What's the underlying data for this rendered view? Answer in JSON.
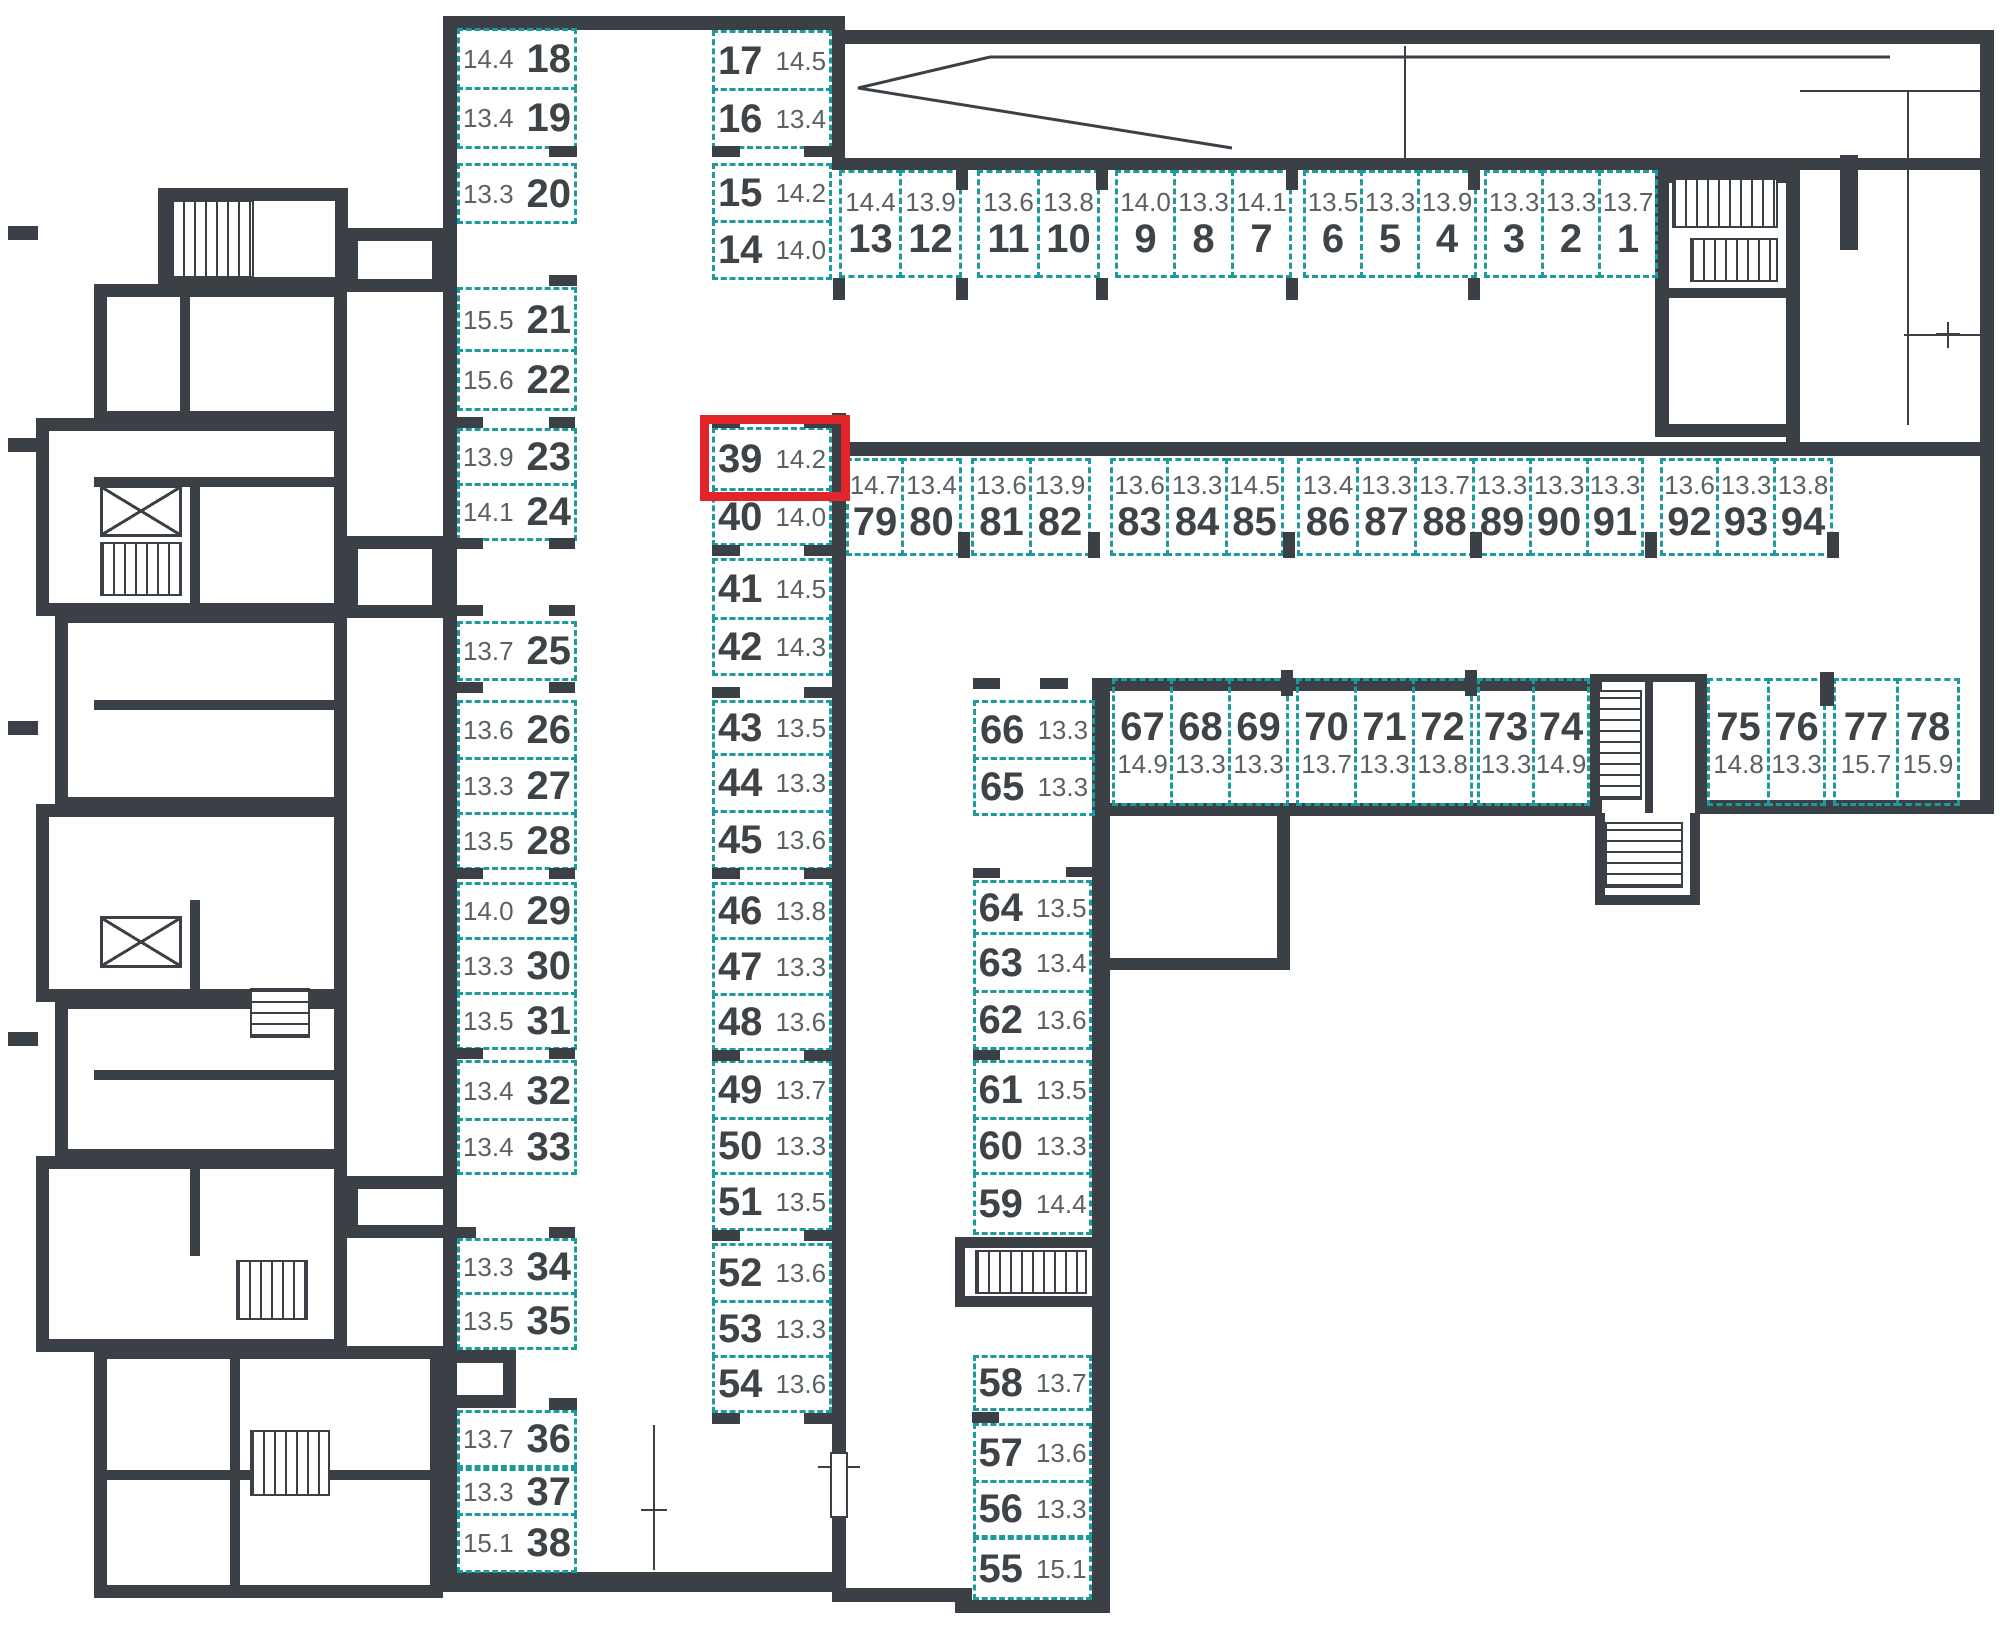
{
  "title": "Underground parking floor plan",
  "colors": {
    "wall": "#3a4045",
    "space_border": "#1f9a9c",
    "number": "#3e4347",
    "area_text": "#5a6165",
    "highlight": "#e2242b"
  },
  "highlighted_space": "39",
  "direction_arrow": "left",
  "groups": {
    "col_left": {
      "spaces": [
        {
          "n": "18",
          "a": "14.4"
        },
        {
          "n": "19",
          "a": "13.4"
        },
        {
          "n": "20",
          "a": "13.3"
        },
        {
          "n": "21",
          "a": "15.5"
        },
        {
          "n": "22",
          "a": "15.6"
        },
        {
          "n": "23",
          "a": "13.9"
        },
        {
          "n": "24",
          "a": "14.1"
        },
        {
          "n": "25",
          "a": "13.7"
        },
        {
          "n": "26",
          "a": "13.6"
        },
        {
          "n": "27",
          "a": "13.3"
        },
        {
          "n": "28",
          "a": "13.5"
        },
        {
          "n": "29",
          "a": "14.0"
        },
        {
          "n": "30",
          "a": "13.3"
        },
        {
          "n": "31",
          "a": "13.5"
        },
        {
          "n": "32",
          "a": "13.4"
        },
        {
          "n": "33",
          "a": "13.4"
        },
        {
          "n": "34",
          "a": "13.3"
        },
        {
          "n": "35",
          "a": "13.5"
        },
        {
          "n": "36",
          "a": "13.7"
        },
        {
          "n": "37",
          "a": "13.3"
        },
        {
          "n": "38",
          "a": "15.1"
        }
      ]
    },
    "col_mid_top": {
      "spaces": [
        {
          "n": "17",
          "a": "14.5"
        },
        {
          "n": "16",
          "a": "13.4"
        },
        {
          "n": "15",
          "a": "14.2"
        },
        {
          "n": "14",
          "a": "14.0"
        }
      ]
    },
    "col_mid": {
      "spaces": [
        {
          "n": "39",
          "a": "14.2"
        },
        {
          "n": "40",
          "a": "14.0"
        },
        {
          "n": "41",
          "a": "14.5"
        },
        {
          "n": "42",
          "a": "14.3"
        },
        {
          "n": "43",
          "a": "13.5"
        },
        {
          "n": "44",
          "a": "13.3"
        },
        {
          "n": "45",
          "a": "13.6"
        },
        {
          "n": "46",
          "a": "13.8"
        },
        {
          "n": "47",
          "a": "13.3"
        },
        {
          "n": "48",
          "a": "13.6"
        },
        {
          "n": "49",
          "a": "13.7"
        },
        {
          "n": "50",
          "a": "13.3"
        },
        {
          "n": "51",
          "a": "13.5"
        },
        {
          "n": "52",
          "a": "13.6"
        },
        {
          "n": "53",
          "a": "13.3"
        },
        {
          "n": "54",
          "a": "13.6"
        }
      ]
    },
    "row_top": {
      "spaces": [
        {
          "n": "13",
          "a": "14.4"
        },
        {
          "n": "12",
          "a": "13.9"
        },
        {
          "n": "11",
          "a": "13.6"
        },
        {
          "n": "10",
          "a": "13.8"
        },
        {
          "n": "9",
          "a": "14.0"
        },
        {
          "n": "8",
          "a": "13.3"
        },
        {
          "n": "7",
          "a": "14.1"
        },
        {
          "n": "6",
          "a": "13.5"
        },
        {
          "n": "5",
          "a": "13.3"
        },
        {
          "n": "4",
          "a": "13.9"
        },
        {
          "n": "3",
          "a": "13.3"
        },
        {
          "n": "2",
          "a": "13.3"
        },
        {
          "n": "1",
          "a": "13.7"
        }
      ]
    },
    "row_79": {
      "spaces": [
        {
          "n": "79",
          "a": "14.7"
        },
        {
          "n": "80",
          "a": "13.4"
        },
        {
          "n": "81",
          "a": "13.6"
        },
        {
          "n": "82",
          "a": "13.9"
        },
        {
          "n": "83",
          "a": "13.6"
        },
        {
          "n": "84",
          "a": "13.3"
        },
        {
          "n": "85",
          "a": "14.5"
        },
        {
          "n": "86",
          "a": "13.4"
        },
        {
          "n": "87",
          "a": "13.3"
        },
        {
          "n": "88",
          "a": "13.7"
        },
        {
          "n": "89",
          "a": "13.3"
        },
        {
          "n": "90",
          "a": "13.3"
        },
        {
          "n": "91",
          "a": "13.3"
        },
        {
          "n": "92",
          "a": "13.6"
        },
        {
          "n": "93",
          "a": "13.3"
        },
        {
          "n": "94",
          "a": "13.8"
        }
      ]
    },
    "pair_66": {
      "spaces": [
        {
          "n": "66",
          "a": "13.3"
        },
        {
          "n": "65",
          "a": "13.3"
        }
      ]
    },
    "row_67": {
      "spaces": [
        {
          "n": "67",
          "a": "14.9"
        },
        {
          "n": "68",
          "a": "13.3"
        },
        {
          "n": "69",
          "a": "13.3"
        },
        {
          "n": "70",
          "a": "13.7"
        },
        {
          "n": "71",
          "a": "13.3"
        },
        {
          "n": "72",
          "a": "13.8"
        },
        {
          "n": "73",
          "a": "13.3"
        },
        {
          "n": "74",
          "a": "14.9"
        }
      ]
    },
    "row_75": {
      "spaces": [
        {
          "n": "75",
          "a": "14.8"
        },
        {
          "n": "76",
          "a": "13.3"
        },
        {
          "n": "77",
          "a": "15.7"
        },
        {
          "n": "78",
          "a": "15.9"
        }
      ]
    },
    "col_64": {
      "spaces": [
        {
          "n": "64",
          "a": "13.5"
        },
        {
          "n": "63",
          "a": "13.4"
        },
        {
          "n": "62",
          "a": "13.6"
        },
        {
          "n": "61",
          "a": "13.5"
        },
        {
          "n": "60",
          "a": "13.3"
        },
        {
          "n": "59",
          "a": "14.4"
        }
      ]
    },
    "col_58": {
      "spaces": [
        {
          "n": "58",
          "a": "13.7"
        },
        {
          "n": "57",
          "a": "13.6"
        },
        {
          "n": "56",
          "a": "13.3"
        },
        {
          "n": "55",
          "a": "15.1"
        }
      ]
    }
  }
}
